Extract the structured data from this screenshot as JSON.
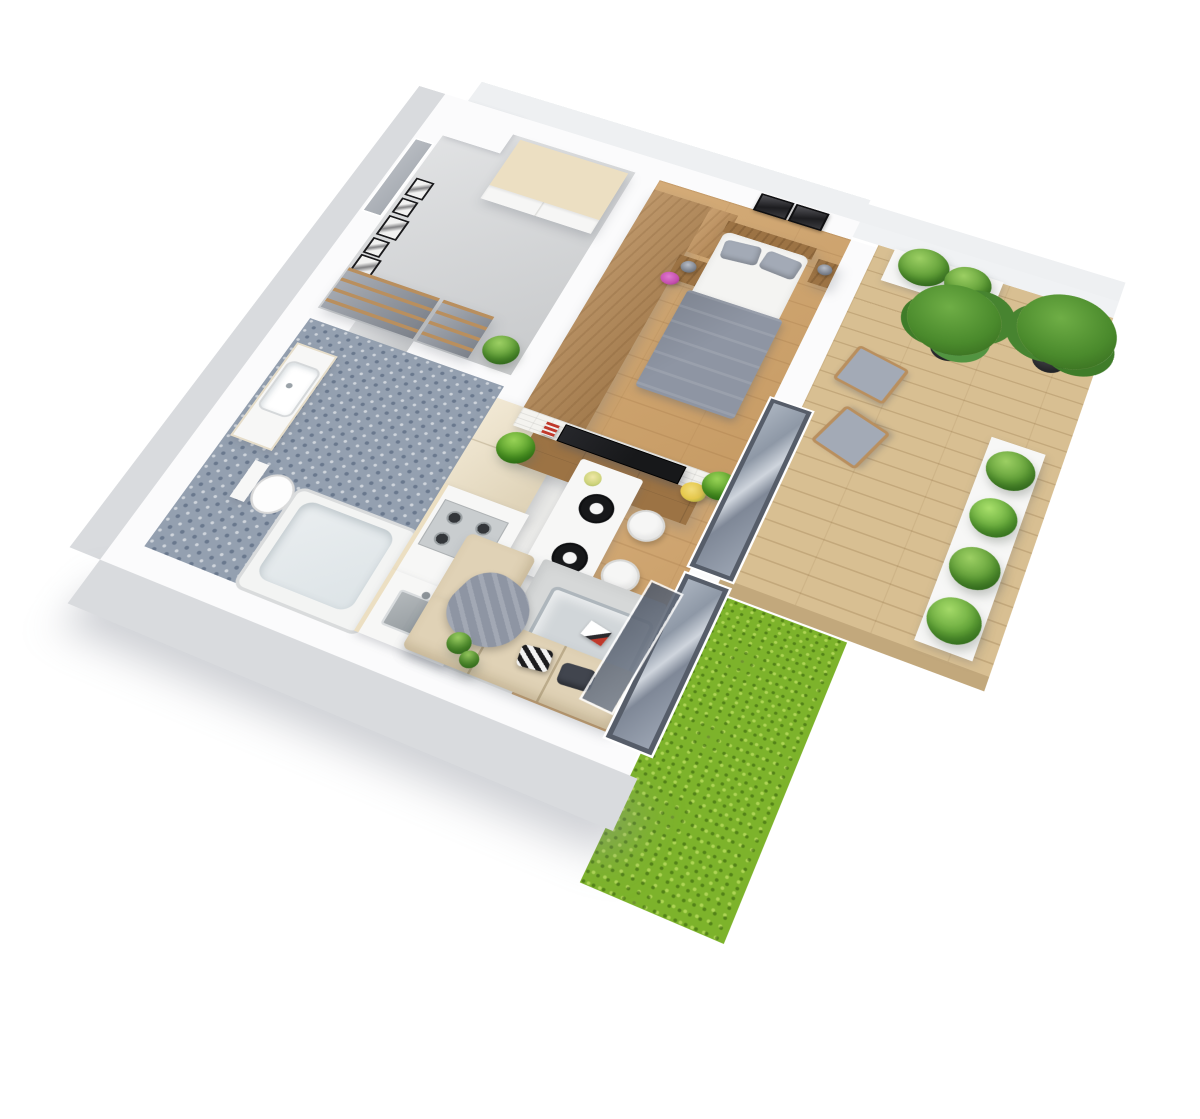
{
  "scene": {
    "type": "isometric-3d-floor-plan-render",
    "description": "3D cutaway floor plan of a small apartment with white walls, wood floors, a terrace deck and a green lawn strip",
    "rooms": [
      {
        "name": "hallway",
        "floor": "gray-concrete",
        "items": [
          "entrance-door",
          "gallery-of-six-black-frames",
          "white-wardrobe-with-beige-top",
          "gray-sliding-wardrobe-with-wood-slats",
          "gray-sliding-wardrobe-small",
          "potted-plant"
        ]
      },
      {
        "name": "bedroom",
        "floor": "oak-plank",
        "wall_finish": "herringbone-wallpaper",
        "items": [
          "oak-wardrobe",
          "double-bed-gray-bedding",
          "two-gray-pillows",
          "gray-duvet",
          "walnut-nightstand-left",
          "walnut-nightstand-right",
          "gray-table-lamp-left",
          "gray-table-lamp-right",
          "purple-flowers",
          "two-black-wall-art-frames",
          "white-brick-half-wall"
        ]
      },
      {
        "name": "living-room",
        "floor": "oak-plank",
        "items": [
          "tv-sideboard-white-drawers-wood-top",
          "flat-screen-tv",
          "red-books",
          "yellow-flowers",
          "palm-plant-left",
          "palm-plant-right",
          "light-gray-area-rug",
          "glass-coffee-table",
          "magazine",
          "beige-corner-sofa",
          "black-white-patterned-pillow",
          "dark-navy-pillow",
          "gray-throw-blanket",
          "small-green-plants"
        ]
      },
      {
        "name": "kitchen",
        "floor": "pale-gray",
        "items": [
          "cream-tall-cabinets",
          "gas-hob-four-burners",
          "oven",
          "white-countertop",
          "inset-sink"
        ]
      },
      {
        "name": "dining-area",
        "floor": "pale-gray",
        "items": [
          "white-dining-table",
          "two-black-plates",
          "flower-vase-yellow-blossoms",
          "two-white-chairs-wood-legs"
        ]
      },
      {
        "name": "bathroom",
        "floor": "blue-mosaic-tile",
        "items": [
          "vanity-with-white-basin",
          "toilet",
          "bathtub"
        ]
      },
      {
        "name": "terrace",
        "floor": "wood-deck",
        "items": [
          "two-wood-armchairs-gray-cushions",
          "two-potted-trees-black-pots",
          "white-planter-box-north",
          "white-planter-row-east-four-shrubs",
          "glass-sliding-door-bedroom",
          "glass-sliding-door-living",
          "tilted-open-glass-panel"
        ]
      },
      {
        "name": "garden",
        "floor": "grass",
        "items": [
          "bright-green-lawn-strip"
        ]
      }
    ]
  },
  "palette": {
    "wall-top": "#fbfbfc",
    "wall-face": "#d9dbde",
    "wall-face-light": "#eef0f2",
    "wood": "#cfa269",
    "deck": "#d8bf92",
    "deck-edge": "#c2a87c",
    "concrete": "#d3d5d7",
    "tile-blue": "#94a0b0",
    "floor-pale": "#e9e9e7",
    "grass": "#7db32b",
    "cream": "#ecdfc2",
    "oak": "#b58956",
    "walnut": "#9c7344",
    "white-furn": "#f7f7f6",
    "gray-door": "#8d939d",
    "slat-wood": "#b98f5e",
    "glass-frame": "#565d69",
    "glass-blue": "#97a1af",
    "tv-black": "#17181a",
    "bed-gray": "#8e95a3",
    "pillow-gray": "#a3aab6",
    "lamp-gray": "#6f7580",
    "sofa-beige": "#e0d2b6",
    "rug": "#d6d8d8",
    "plant-green": "#5d9c35",
    "plant-dark": "#3f7a24",
    "tree-green": "#4a8a2c",
    "pot-black": "#232427",
    "stainless": "#c9cdcf",
    "flower-yellow": "#e6c84b",
    "flower-purple": "#c44fae",
    "brick-white": "#f4f3ef",
    "red-accent": "#c0392b",
    "door-gray": "#b8bcc2"
  }
}
